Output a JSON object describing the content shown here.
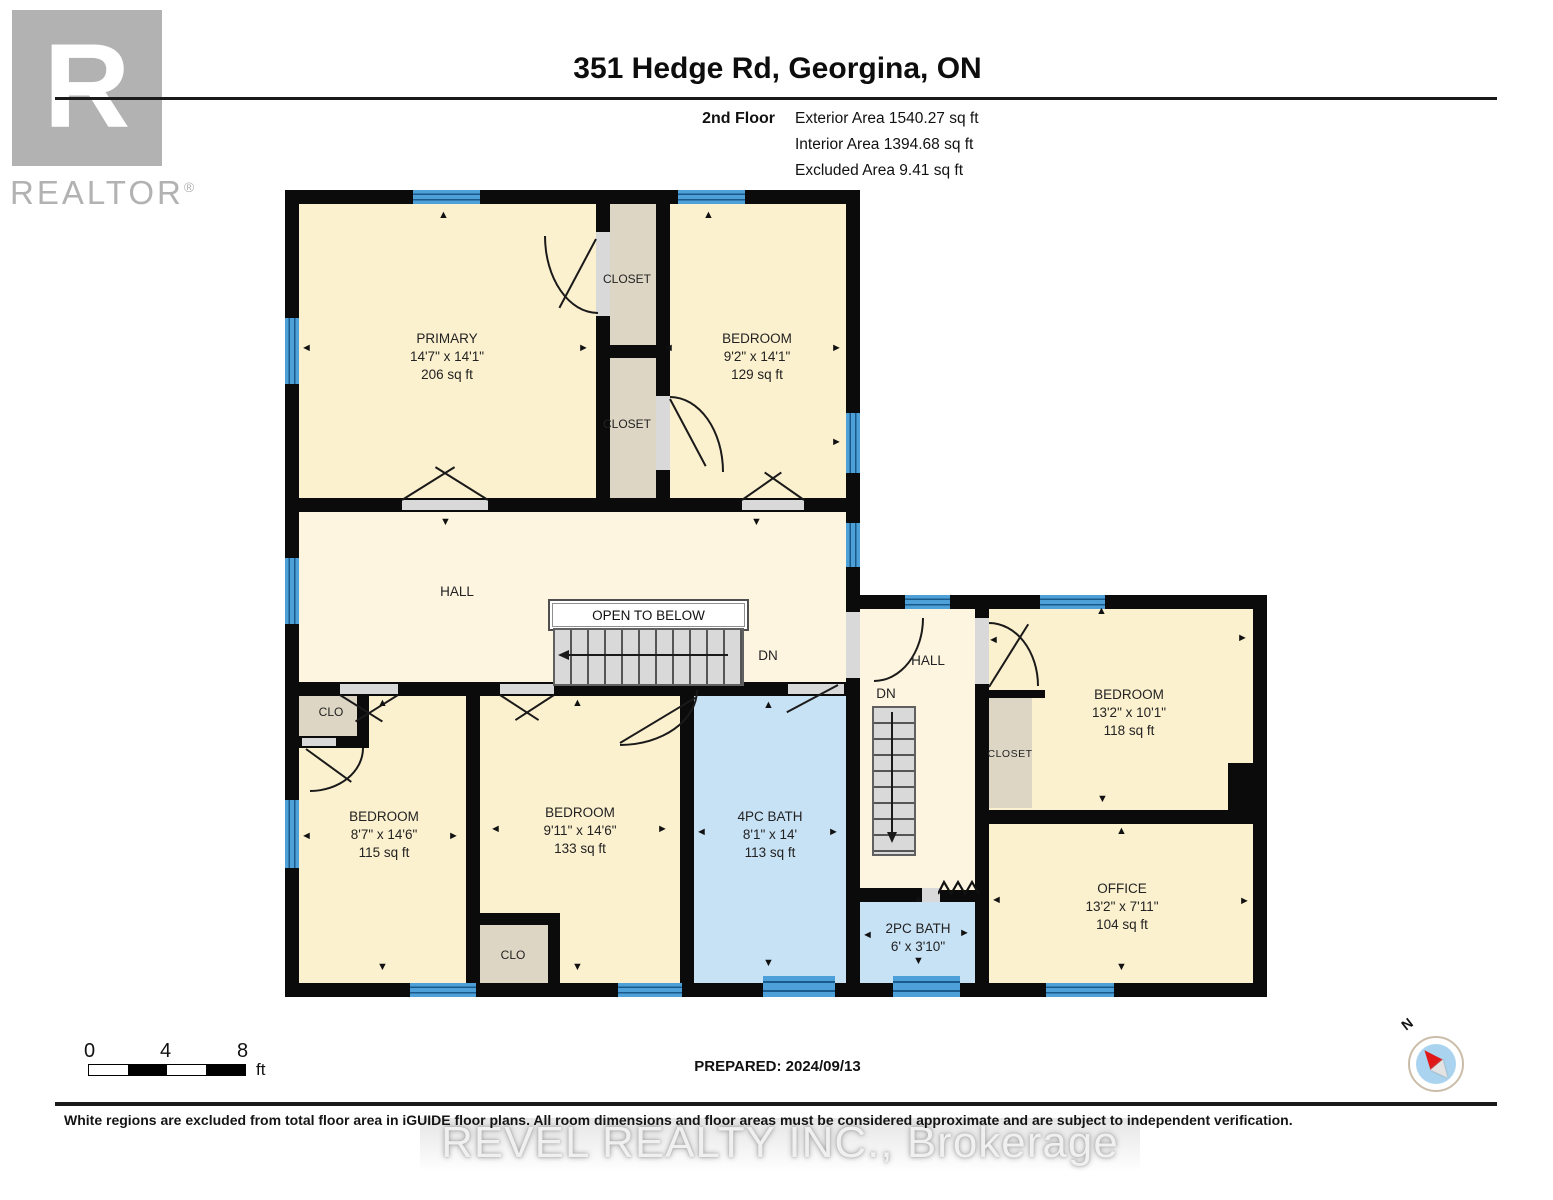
{
  "branding": {
    "logo_letter": "R",
    "realtor_word": "REALTOR",
    "registered": "®"
  },
  "header": {
    "title": "351 Hedge Rd, Georgina, ON",
    "floor_label": "2nd Floor",
    "stats": [
      "Exterior Area 1540.27 sq ft",
      "Interior Area 1394.68 sq ft",
      "Excluded Area 9.41 sq ft"
    ]
  },
  "rooms": {
    "primary": {
      "name": "PRIMARY",
      "dims": "14'7\" x 14'1\"",
      "area": "206 sq ft"
    },
    "bedroom_top": {
      "name": "BEDROOM",
      "dims": "9'2\" x 14'1\"",
      "area": "129 sq ft"
    },
    "closet_top": {
      "name": "CLOSET"
    },
    "closet_mid": {
      "name": "CLOSET"
    },
    "hall_main": {
      "name": "HALL"
    },
    "open_to_below": {
      "label": "OPEN TO BELOW"
    },
    "stair_main": {
      "dn": "DN"
    },
    "clo_left": {
      "name": "CLO"
    },
    "bedroom_left": {
      "name": "BEDROOM",
      "dims": "8'7\" x 14'6\"",
      "area": "115 sq ft"
    },
    "bedroom_mid": {
      "name": "BEDROOM",
      "dims": "9'11\" x 14'6\"",
      "area": "133 sq ft"
    },
    "clo_bottom": {
      "name": "CLO"
    },
    "bath_4pc": {
      "name": "4PC BATH",
      "dims": "8'1\" x 14'",
      "area": "113 sq ft"
    },
    "hall_right": {
      "name": "HALL"
    },
    "stair_right": {
      "dn": "DN"
    },
    "closet_right": {
      "name": "CLOSET"
    },
    "bedroom_right": {
      "name": "BEDROOM",
      "dims": "13'2\" x 10'1\"",
      "area": "118 sq ft"
    },
    "office": {
      "name": "OFFICE",
      "dims": "13'2\" x 7'11\"",
      "area": "104 sq ft"
    },
    "bath_2pc": {
      "name": "2PC BATH",
      "dims": "6' x 3'10\""
    }
  },
  "scale_bar": {
    "ticks": [
      "0",
      "4",
      "8"
    ],
    "unit": "ft"
  },
  "compass": {
    "north": "N"
  },
  "footer": {
    "prepared": "PREPARED: 2024/09/13",
    "disclaimer": "White regions are excluded from total floor area in iGUIDE floor plans. All room dimensions and floor areas must be considered approximate and are subject to independent verification.",
    "watermark": "REVEL REALTY INC., Brokerage"
  },
  "icons": {
    "arrow_up": "▲",
    "arrow_down": "▼",
    "arrow_left": "◄",
    "arrow_right": "►"
  },
  "colors": {
    "wall": "#0b0b0b",
    "room_fill": "#fcf1cf",
    "hall_fill": "#fdf5e0",
    "closet_fill": "#ded6c4",
    "bath_fill": "#c8e2f5",
    "window_blue": "#4da0d8",
    "stair_gray": "#d9d9d9",
    "logo_gray": "#b2b2b2",
    "compass_red": "#e01818",
    "compass_blue": "#a9d3ee"
  }
}
